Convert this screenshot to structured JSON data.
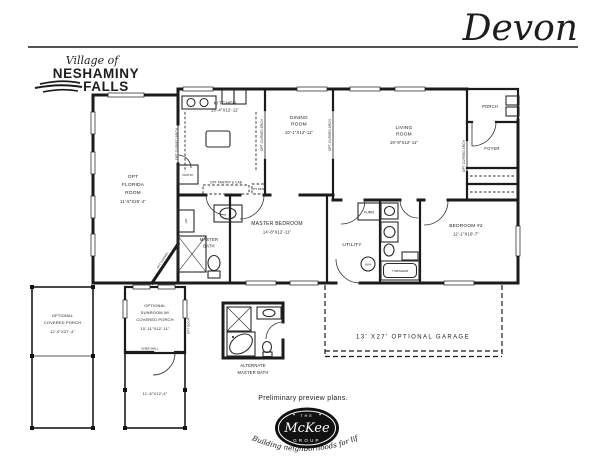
{
  "header": {
    "model_name": "Devon",
    "community": {
      "prefix": "Village of",
      "name_line1": "NESHAMINY",
      "name_line2": "FALLS"
    }
  },
  "rooms": {
    "kitchen": {
      "lines": [
        "KITCHEN",
        "13'-4\"X12'-11\""
      ]
    },
    "dining_room": {
      "lines": [
        "DINING",
        "ROOM",
        "10'-1\"X12'-11\""
      ]
    },
    "living_room": {
      "lines": [
        "LIVING",
        "ROOM",
        "19'-9\"X12'-11\""
      ]
    },
    "porch": {
      "lines": [
        "PORCH"
      ]
    },
    "foyer": {
      "lines": [
        "FOYER"
      ]
    },
    "opt_florida_room": {
      "lines": [
        "OPT",
        "FLORIDA",
        "ROOM",
        "11'-5\"X26'-4\""
      ]
    },
    "master_bedroom": {
      "lines": [
        "MASTER BEDROOM",
        "14'-8\"X12'-11\""
      ]
    },
    "master_bath": {
      "lines": [
        "MASTER",
        "BATH"
      ]
    },
    "utility": {
      "lines": [
        "UTILITY"
      ]
    },
    "bedroom_2": {
      "lines": [
        "BEDROOM #2",
        "12'-1\"X10'-7\""
      ]
    },
    "optional_covered_porch": {
      "lines": [
        "OPTIONAL",
        "COVERED PORCH",
        "12'-0\"X27'-4\""
      ]
    },
    "optional_sunroom": {
      "lines": [
        "OPTIONAL",
        "SUNROOM W/",
        "COVERED PORCH",
        "10'-11\"X12'-11\""
      ],
      "lower_dims": "11'-6\"X12'-4\""
    },
    "alternate_master_bath": {
      "lines": [
        "ALTERNATE",
        "MASTER BATH"
      ]
    },
    "optional_garage": {
      "label": "13' X27' OPTIONAL GARAGE"
    }
  },
  "annotations": {
    "opt_curved_arch": "OPT CURVED ARCH",
    "opt_pantry_cab": "OPT PANTRY & CAB",
    "pantry": "PANTRY",
    "opt_desk": "OPT DESK",
    "opt_corner_fireplace_1": "OPT CORNER",
    "opt_corner_fireplace_2": "FIREPLACE",
    "linen": "LIN",
    "furnace": "FURN",
    "water_heater": "W/H",
    "tub_shower": "TUB/SHWR",
    "knee_wall": "KNEE WALL",
    "opt_door": "OPT DOOR"
  },
  "footer": {
    "preliminary_note": "Preliminary preview plans.",
    "logo": {
      "the": "THE",
      "name": "McKee",
      "group": "GROUP",
      "tagline": "Building neighborhoods for life"
    }
  }
}
